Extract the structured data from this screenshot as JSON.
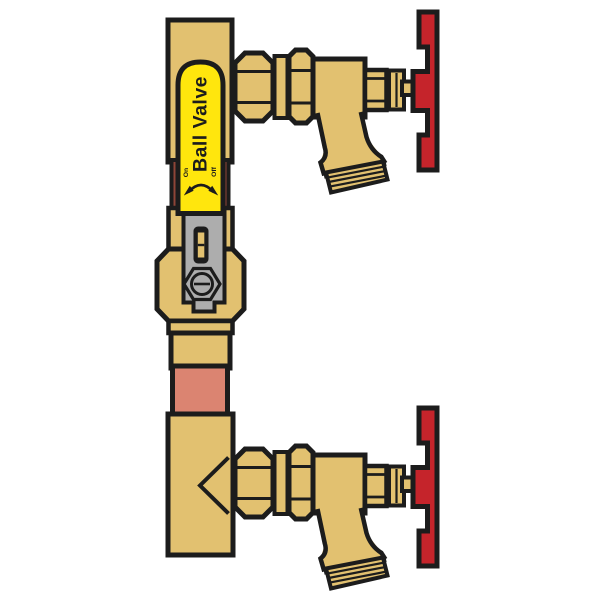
{
  "colors": {
    "background": "#FFFFFF",
    "outline": "#1C1C1C",
    "brass": "#E2C170",
    "tag_yellow": "#FFE60D",
    "handle_red": "#C5242B",
    "copper": "#DB8471",
    "copper_dark": "#8E4537",
    "lever_gray": "#ADADAD"
  },
  "tag": {
    "label": "Ball Valve",
    "on_label": "On",
    "off_label": "Off"
  }
}
